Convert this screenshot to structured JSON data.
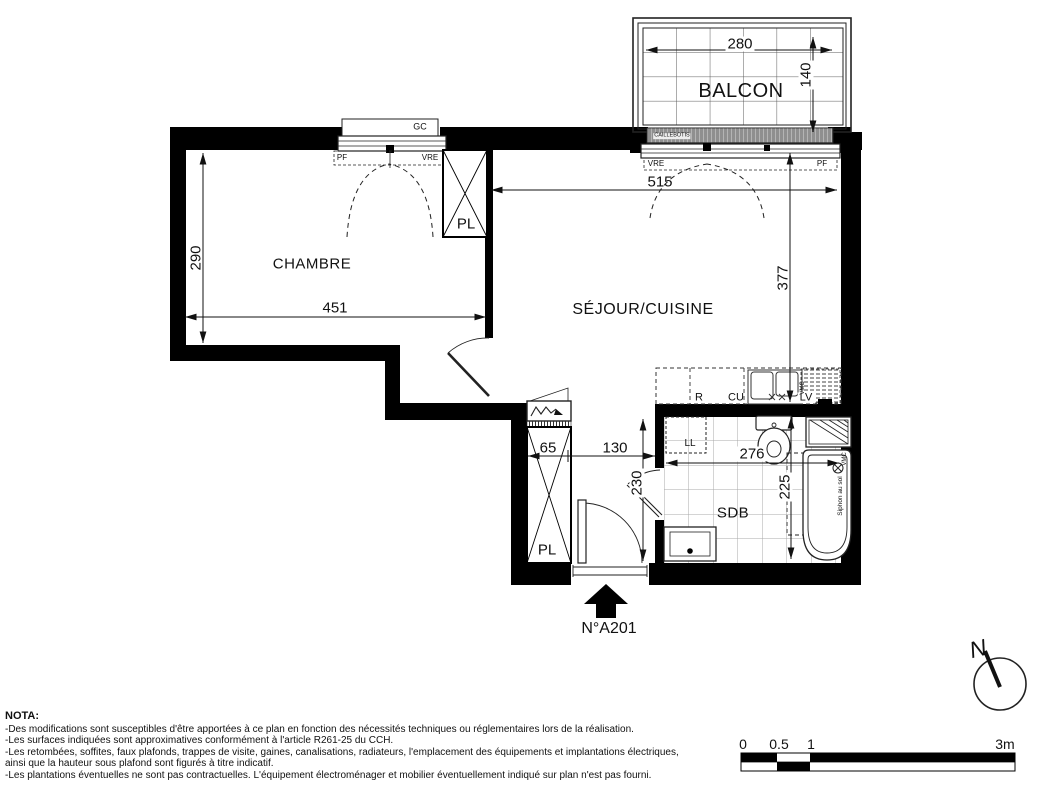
{
  "title": {
    "unit_label": "N°A201"
  },
  "plan": {
    "rooms": {
      "balcony": "BALCON",
      "bedroom": "CHAMBRE",
      "living_kitchen": "SÉJOUR/CUISINE",
      "bathroom": "SDB",
      "closet_bedroom": "PL",
      "closet_hall": "PL"
    },
    "dimensions": {
      "balcony_width": "280",
      "balcony_depth": "140",
      "living_width": "515",
      "living_depth": "377",
      "bedroom_depth": "290",
      "bedroom_width": "451",
      "closet_width": "65",
      "hall_width": "130",
      "hall_depth": "230",
      "bath_width": "276",
      "bath_depth": "225"
    },
    "annotations": {
      "gc": "GC",
      "pf_left": "PF",
      "vre_left": "VRE",
      "vre_right": "VRE",
      "pf_right": "PF",
      "caillebotis": "CAILLEBOTIS",
      "fridge": "R",
      "cooktop": "CU",
      "dishwasher": "LV",
      "washing_machine": "LL",
      "vmc_kitchen": "VMC",
      "vmc_bath": "VMC",
      "siphon": "Siphon au sol",
      "north": "N"
    }
  },
  "nota": {
    "title": "NOTA:",
    "lines": [
      "-Des modifications sont susceptibles d'être apportées à ce plan en fonction des nécessités techniques ou réglementaires lors de la réalisation.",
      "-Les surfaces indiquées sont approximatives conformément à l'article R261-25 du CCH.",
      "-Les retombées, soffites, faux plafonds, trappes de visite, gaines, canalisations, radiateurs, l'emplacement des équipements et implantations électriques,",
      "ainsi que la hauteur sous plafond sont figurés à titre indicatif.",
      "-Les plantations éventuelles ne sont pas contractuelles. L'équipement électroménager et mobilier éventuellement indiqué sur plan n'est pas fourni."
    ]
  },
  "scale_bar": {
    "labels": [
      "0",
      "0.5",
      "1",
      "3m"
    ]
  }
}
